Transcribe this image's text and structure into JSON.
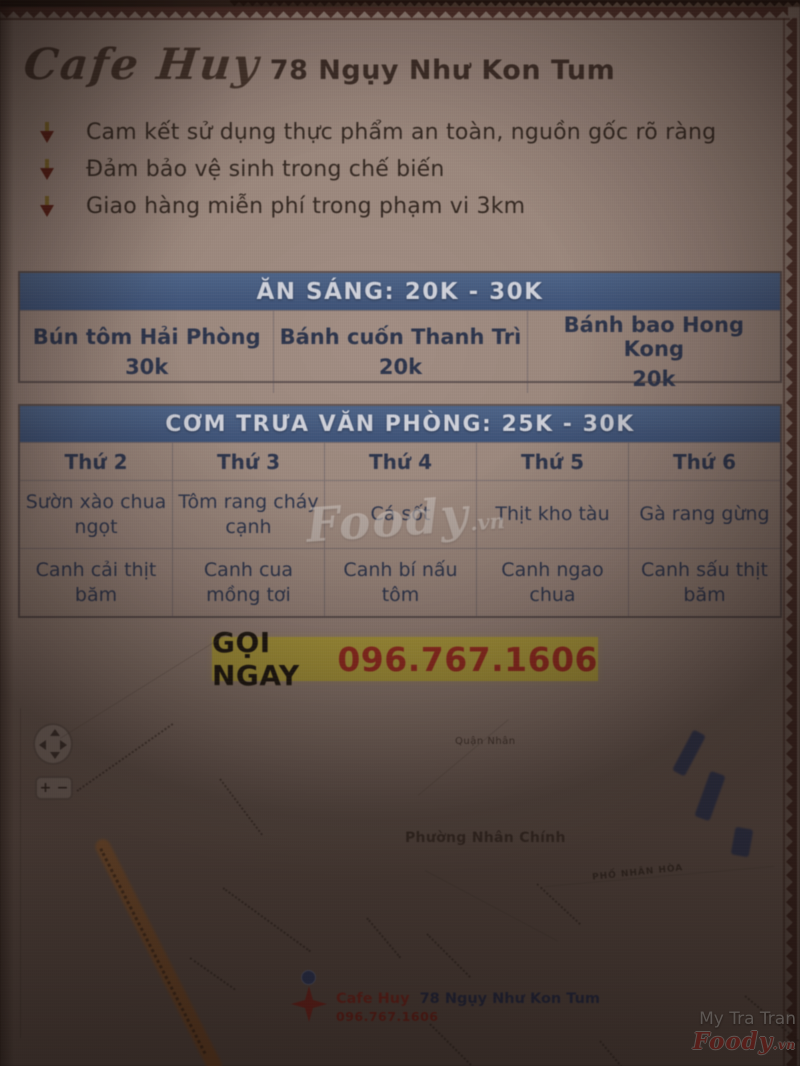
{
  "header": {
    "brand": "Cafe Huy",
    "address": "78 Ngụy Như Kon Tum"
  },
  "commitments": [
    "Cam kết sử dụng thực phẩm an toàn, nguồn gốc rõ ràng",
    "Đảm bảo vệ sinh trong chế biến",
    "Giao hàng miễn phí trong phạm vi 3km"
  ],
  "breakfast": {
    "title": "ĂN SÁNG: 20K - 30K",
    "items": [
      {
        "name": "Bún tôm Hải Phòng",
        "price": "30k"
      },
      {
        "name": "Bánh cuốn Thanh Trì",
        "price": "20k"
      },
      {
        "name": "Bánh bao Hong Kong",
        "price": "20k"
      }
    ]
  },
  "lunch": {
    "title": "CƠM TRƯA VĂN PHÒNG: 25K - 30K",
    "days": [
      "Thứ 2",
      "Thứ 3",
      "Thứ 4",
      "Thứ 5",
      "Thứ 6"
    ],
    "mains": [
      "Sườn xào chua ngọt",
      "Tôm rang cháy cạnh",
      "Cá sốt",
      "Thịt kho tàu",
      "Gà rang gừng"
    ],
    "soups": [
      "Canh cải thịt băm",
      "Canh cua mồng tơi",
      "Canh bí nấu tôm",
      "Canh ngao chua",
      "Canh sấu thịt băm"
    ]
  },
  "cta": {
    "label": "GỌI NGAY",
    "phone": "096.767.1606"
  },
  "map": {
    "district": "Quận Nhân",
    "ward": "Phường Nhân Chính",
    "street": "PHỐ NHÂN HÒA",
    "zoom_in": "+",
    "zoom_out": "−",
    "marker": {
      "brand": "Cafe Huy",
      "address": "78 Ngụy Như Kon Tum",
      "phone": "096.767.1606"
    }
  },
  "watermark": {
    "center_text": "Foody",
    "center_tld": ".vn",
    "credit": "My Tra Tran",
    "logo_text": "Foody",
    "logo_tld": ".vn"
  },
  "colors": {
    "table_header_blue": "#3f5b86",
    "highlight_yellow": "#b1a13d",
    "phone_red": "#9a2a20",
    "marker_red": "#a8322a",
    "foody_logo_red": "#e8473e",
    "paper": "#9c8a81"
  }
}
